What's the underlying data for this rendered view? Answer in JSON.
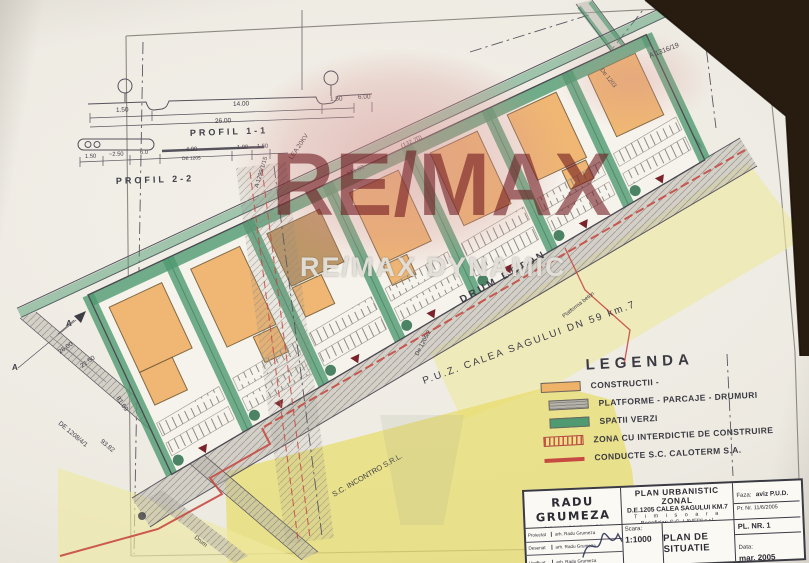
{
  "colors": {
    "photo_bg": "#261a10",
    "paper": "#efece5",
    "ink": "#44434a",
    "construction_orange": "#efb269",
    "construction_brown": "#b9905c",
    "green": "#4f9a71",
    "green_dark": "#2e6e4e",
    "road_gray": "#b7b4ac",
    "hatch_gray": "#8e8b84",
    "red": "#c74a42",
    "yellow_light": "#efe9a0",
    "yellow_deep": "#e7dc6a",
    "watermark_pink": "#d69290",
    "watermark_red": "#70161c"
  },
  "watermark": {
    "remax": "RE/MAX",
    "dynamic": "RE/MAX DYNAMIC"
  },
  "profiles": {
    "p1": {
      "label": "PROFIL 1-1",
      "d1": "1.50",
      "d2": "14.00",
      "d3": "1.50",
      "d4": "6.00",
      "total": "26.00"
    },
    "p2": {
      "label": "PROFIL 2-2",
      "d1": "1.50",
      "d2": "~2.50",
      "d3": "6.0",
      "d4": "4.00",
      "d5": "1.00",
      "d6": "1.50",
      "road": "DE 1205"
    }
  },
  "plan": {
    "labels": {
      "drum_beton": "DRUM BETON",
      "puz": "P.U.Z. CALEA SAGULUI DN 59 km.7",
      "platforma": "Platforma beton",
      "incontro": "S.C. INCONTRO S.R.L.",
      "a1316": "A 1316/19",
      "a1299": "A 1299/1/15",
      "lea": "LEA 20KV",
      "de1208": "DE 1208/4/1",
      "de1203": "De 1203",
      "de1205_2": "De 1205/2",
      "drum": "Drum",
      "dim_26": "26.00",
      "dim_2150": "21.50",
      "dim_9382": "93.82",
      "dim_8169": "81.69",
      "dim_13270": "(132.70)",
      "dim_171": "171.00",
      "marker_a": "A"
    }
  },
  "legend": {
    "title": "LEGENDA",
    "items": [
      {
        "label": "CONSTRUCTII -"
      },
      {
        "label": "PLATFORME - PARCAJE - DRUMURI"
      },
      {
        "label": "SPATII VERZI"
      },
      {
        "label": "ZONA CU INTERDICTIE DE CONSTRUIRE"
      },
      {
        "label": "CONDUCTE S.C. CALOTERM S.A."
      }
    ]
  },
  "titleblock": {
    "architect": "RADU GRUMEZA",
    "office": "BIROU INDIVIDUAL DE ARHITECTURA",
    "rows": [
      {
        "role": "Proiectat",
        "name": "arh. Radu Grumeza"
      },
      {
        "role": "Desenat",
        "name": "arh. Radu Grumeza"
      },
      {
        "role": "Verificat",
        "name": "arh. Radu Grumeza"
      }
    ],
    "project_title": "PLAN URBANISTIC ZONAL",
    "project_subtitle": "D.E.1205 CALEA SAGULUI KM.7",
    "city": "T i m i s o a r a",
    "beneficiar": "Beneficiar: S.C. LAVEDI s.r.l.",
    "scara_label": "Scara:",
    "scara_value": "1:1000",
    "plan_name": "PLAN DE SITUATIE",
    "faza_label": "Faza:",
    "faza_value": "aviz P.U.D.",
    "pr_nr": "Pr. Nr. 11/6/2005",
    "pl_nr": "PL. NR. 1",
    "data_label": "Data:",
    "data_value": "mar. 2005"
  }
}
